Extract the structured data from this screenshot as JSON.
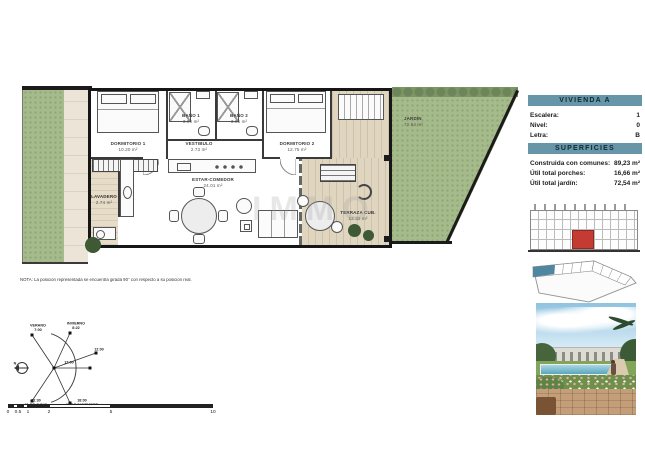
{
  "panel": {
    "title": "VIVIENDA A",
    "info": [
      {
        "label": "Escalera:",
        "value": "1"
      },
      {
        "label": "Nivel:",
        "value": "0"
      },
      {
        "label": "Letra:",
        "value": "B"
      }
    ],
    "superficies_title": "SUPERFICIES",
    "superficies": [
      {
        "label": "Construida con comunes:",
        "value": "89,23 m²"
      },
      {
        "label": "Útil total porches:",
        "value": "16,66 m²"
      },
      {
        "label": "Útil total jardín:",
        "value": "72,54 m²"
      }
    ]
  },
  "plan": {
    "rooms": [
      {
        "name": "DORMITORIO 1",
        "area": "10.20 m²"
      },
      {
        "name": "BAÑO 1",
        "area": "3.90 m²"
      },
      {
        "name": "VESTIBULO",
        "area": "2.73 m²"
      },
      {
        "name": "BAÑO 2",
        "area": "3.85 m²"
      },
      {
        "name": "DORMITORIO 2",
        "area": "12.75 m²"
      },
      {
        "name": "ESTAR-COMEDOR",
        "area": "24.01 m²"
      },
      {
        "name": "LAVADERO",
        "area": "2.74 m²"
      },
      {
        "name": "TERRAZA CUB.",
        "area": "12.32 m²"
      },
      {
        "name": "JARDÍN",
        "area": "72.54 m²"
      }
    ],
    "watermark": "IMMO",
    "note": "NOTA: La posición representada se encuentra girada 90° con respecto a su posición real."
  },
  "sun_diagram": {
    "north": "N",
    "verano": "VERANO",
    "verano_time": "7:00",
    "invierno": "INVIERNO",
    "invierno_time": "8:22",
    "noon_outer": "12:00",
    "noon_inner": "12:00",
    "june_time": "21:30",
    "june_date": "21 DE JUNIO",
    "dec_time": "18:00",
    "dec_date": "21 DE DICIEMBRE"
  },
  "scale_bar": {
    "ticks": [
      "0",
      "0.5",
      "1",
      "2",
      "5",
      "10"
    ]
  },
  "colors": {
    "header_bg": "#6796a9",
    "highlight_red": "#c43b34",
    "highlight_blue": "#4f87a0",
    "grass_green": "#a6bb8b",
    "wood_tan": "#e0d5bf"
  }
}
